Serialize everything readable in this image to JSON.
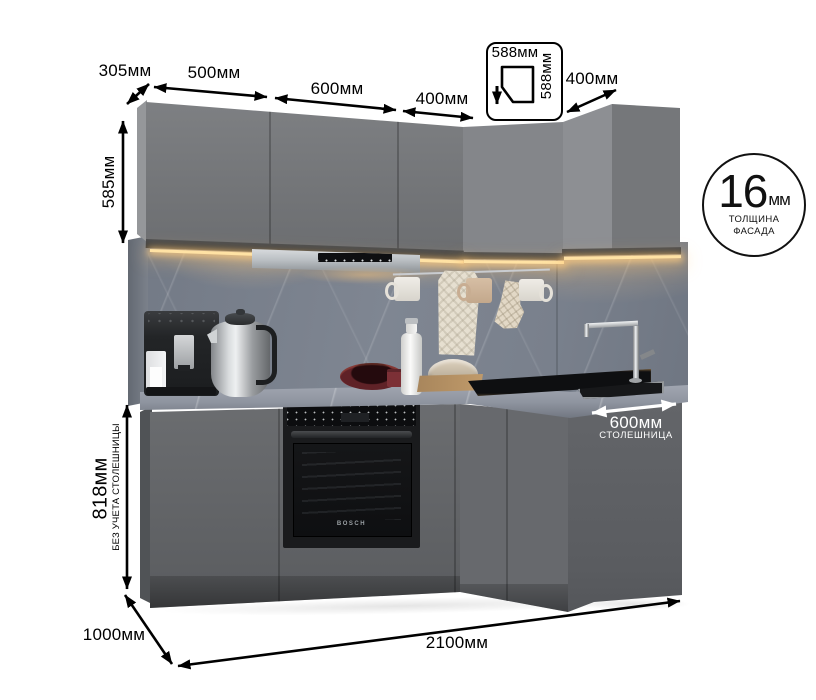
{
  "page": {
    "background": "#ffffff",
    "description": "Corner kitchen set drawing with dimension annotations"
  },
  "annotations": {
    "top_depth_label": "305мм",
    "upper_section_widths": [
      {
        "label": "500мм"
      },
      {
        "label": "600мм"
      },
      {
        "label": "400мм"
      }
    ],
    "corner_cabinet_badge": {
      "top_label": "588мм",
      "side_label": "588мм"
    },
    "right_upper_width_label": "400мм",
    "upper_cabinet_height_label": "585мм",
    "facade_badge": {
      "value": "16",
      "unit": "мм",
      "caption_line1": "ТОЛЩИНА",
      "caption_line2": "ФАСАДА"
    },
    "base_cabinet_height": {
      "label": "818мм",
      "note": "БЕЗ УЧЕТА СТОЛЕШНИЦЫ"
    },
    "countertop_depth": {
      "label": "600мм",
      "caption": "СТОЛЕШНИЦА"
    },
    "total_depth_label": "1000мм",
    "total_width_label": "2100мм"
  },
  "scene": {
    "oven_brand": "BOSCH"
  },
  "colors": {
    "annotation_ink": "#000000",
    "countertop_label_ink": "#ffffff",
    "cabinet_front": "#6e7073",
    "backsplash_marble": "#7d8490",
    "countertop_marble": "#949aa5",
    "led_glow": "#ffd894"
  }
}
